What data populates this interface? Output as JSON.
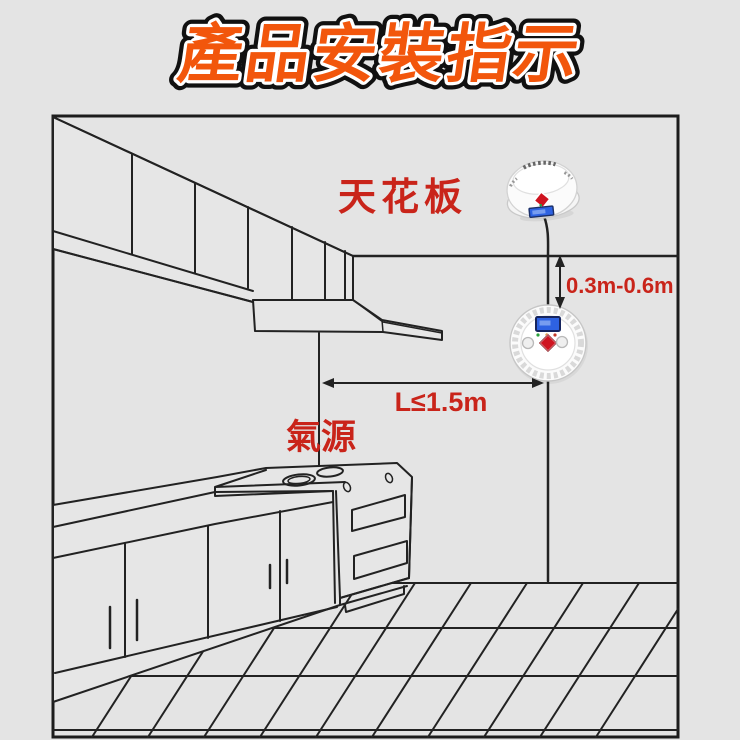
{
  "page": {
    "background_color": "#e4e4e4"
  },
  "title": {
    "text": "產品安裝指示",
    "fill_color": "#f2560c",
    "inner_outline_color": "#ffffff",
    "outer_outline_color": "#111111"
  },
  "diagram": {
    "border_color": "#1c1c1c",
    "line_color": "#222222",
    "label_color": "#c9241a",
    "labels": {
      "ceiling": "天花板",
      "gas_source": "氣源",
      "vertical_distance": "0.3m-0.6m",
      "horizontal_distance": "L≤1.5m"
    },
    "devices": {
      "ceiling_detector_icon": "gas-alarm-detector-tilted",
      "wall_detector_icon": "gas-alarm-detector-front",
      "lcd_color": "#2e62e2",
      "alarm_button_color": "#cf1420",
      "indicator_colors": [
        "#2a9f3a",
        "#d98a1f",
        "#c23b2a"
      ]
    }
  }
}
